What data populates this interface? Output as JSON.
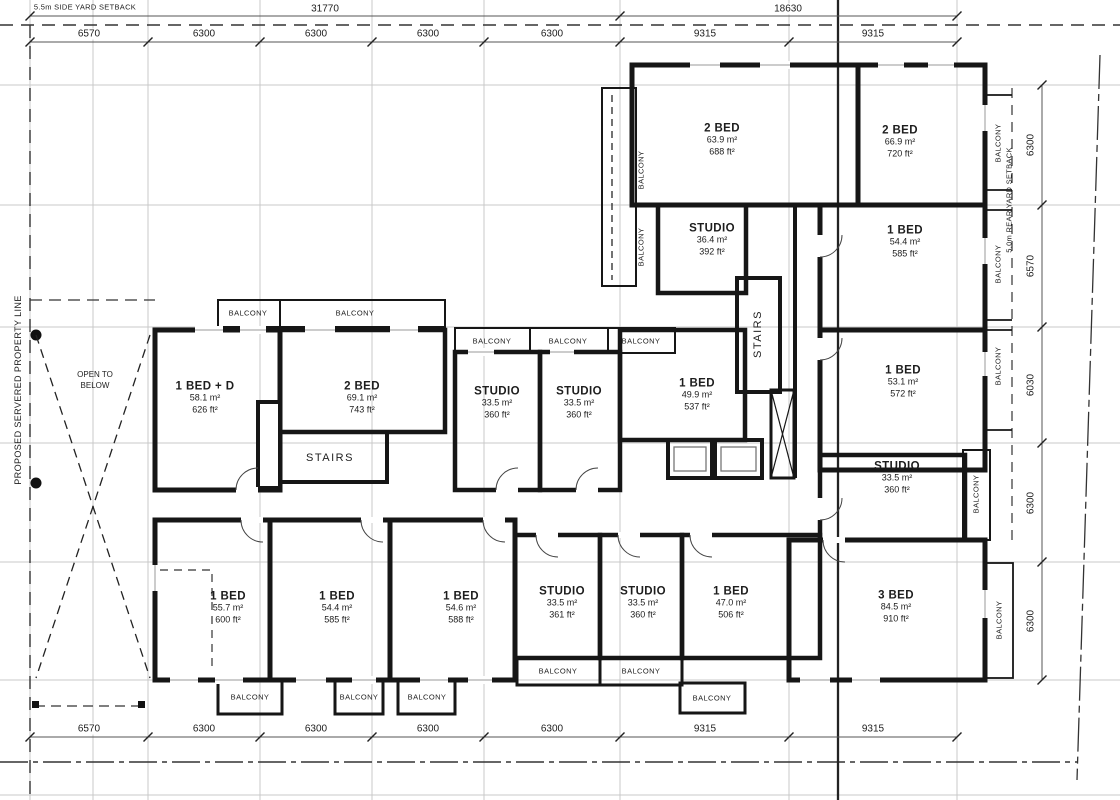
{
  "plan": {
    "setback_side": "5.5m SIDE YARD SETBACK",
    "setback_rear": "5.0m REAR YARD SETBACK",
    "property_line": "PROPOSED SERVERED PROPERTY LINE",
    "open_to_below": "OPEN TO\nBELOW",
    "balcony": "BALCONY",
    "stairs": "STAIRS"
  },
  "dimensions": {
    "top_overall": [
      "31770",
      "18630"
    ],
    "top_segments": [
      "6570",
      "6300",
      "6300",
      "6300",
      "6300",
      "9315",
      "9315"
    ],
    "bottom_segments": [
      "6570",
      "6300",
      "6300",
      "6300",
      "6300",
      "9315",
      "9315"
    ],
    "right_segments": [
      "6300",
      "6570",
      "6030",
      "6300",
      "6300"
    ]
  },
  "rooms": [
    {
      "name": "2 BED",
      "area_m2": "63.9 m²",
      "area_ft2": "688 ft²"
    },
    {
      "name": "2 BED",
      "area_m2": "66.9 m²",
      "area_ft2": "720 ft²"
    },
    {
      "name": "STUDIO",
      "area_m2": "36.4 m²",
      "area_ft2": "392 ft²"
    },
    {
      "name": "1 BED",
      "area_m2": "54.4 m²",
      "area_ft2": "585 ft²"
    },
    {
      "name": "1 BED",
      "area_m2": "53.1 m²",
      "area_ft2": "572 ft²"
    },
    {
      "name": "STUDIO",
      "area_m2": "33.5 m²",
      "area_ft2": "360 ft²"
    },
    {
      "name": "1 BED + D",
      "area_m2": "58.1 m²",
      "area_ft2": "626 ft²"
    },
    {
      "name": "2 BED",
      "area_m2": "69.1 m²",
      "area_ft2": "743 ft²"
    },
    {
      "name": "STUDIO",
      "area_m2": "33.5 m²",
      "area_ft2": "360 ft²"
    },
    {
      "name": "STUDIO",
      "area_m2": "33.5 m²",
      "area_ft2": "360 ft²"
    },
    {
      "name": "1 BED",
      "area_m2": "49.9 m²",
      "area_ft2": "537 ft²"
    },
    {
      "name": "1 BED",
      "area_m2": "55.7 m²",
      "area_ft2": "600 ft²"
    },
    {
      "name": "1 BED",
      "area_m2": "54.4 m²",
      "area_ft2": "585 ft²"
    },
    {
      "name": "1 BED",
      "area_m2": "54.6 m²",
      "area_ft2": "588 ft²"
    },
    {
      "name": "STUDIO",
      "area_m2": "33.5 m²",
      "area_ft2": "361 ft²"
    },
    {
      "name": "STUDIO",
      "area_m2": "33.5 m²",
      "area_ft2": "360 ft²"
    },
    {
      "name": "1 BED",
      "area_m2": "47.0 m²",
      "area_ft2": "506 ft²"
    },
    {
      "name": "3 BED",
      "area_m2": "84.5 m²",
      "area_ft2": "910 ft²"
    }
  ]
}
